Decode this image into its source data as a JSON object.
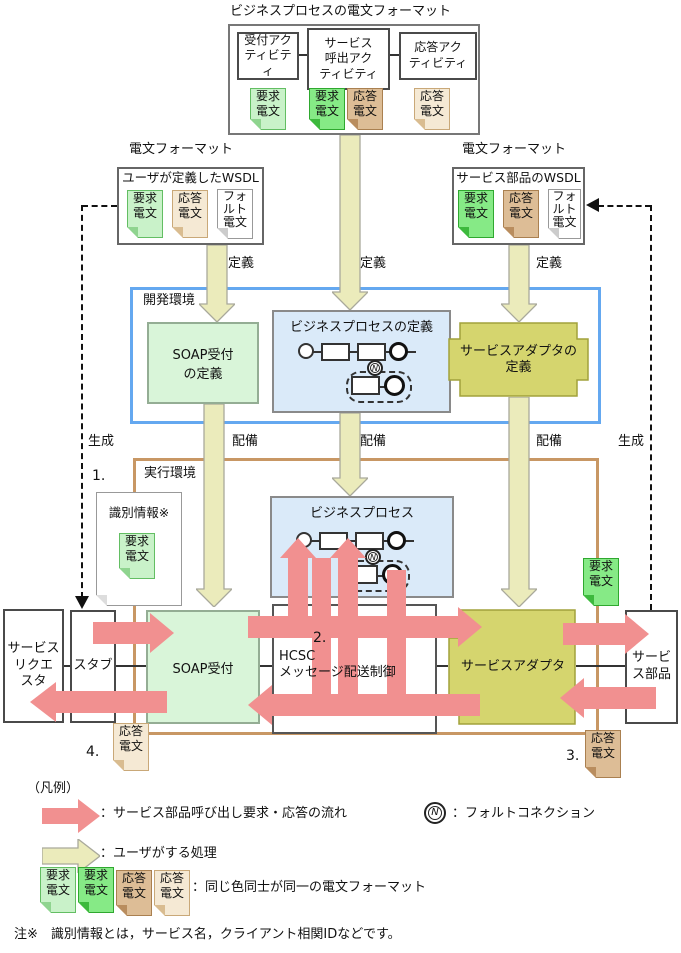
{
  "colors": {
    "pink_arrow": "#F19090",
    "yellow_arrow_fill": "#EBEBBB",
    "yellow_arrow_stroke": "#A9A99B",
    "green_bright": "#86EA86",
    "green_light": "#C9F2C9",
    "tan_dark": "#DDBD96",
    "tan_light": "#F5E9D4",
    "olive": "#D5D56E",
    "dev_border": "#64A8F0",
    "exec_border": "#C89764"
  },
  "top_format": {
    "title": "ビジネスプロセスの電文フォーマット",
    "activities": [
      {
        "label": "受付アク\nティビティ"
      },
      {
        "label": "サービス\n呼出アク\nティビティ"
      },
      {
        "label": "応答アク\nティビティ"
      }
    ]
  },
  "doc_labels": {
    "request": "要求\n電文",
    "response": "応答\n電文",
    "fault": "フォ\nルト\n電文"
  },
  "wsdl_left": {
    "title": "電文フォーマット",
    "label": "ユーザが定義したWSDL"
  },
  "wsdl_right": {
    "title": "電文フォーマット",
    "label": "サービス部品のWSDL"
  },
  "flow_labels": {
    "define": "定義",
    "deploy": "配備",
    "generate": "生成"
  },
  "dev_env": {
    "label": "開発環境",
    "soap_def": "SOAP受付\nの定義",
    "bp_def": "ビジネスプロセスの定義",
    "adapter_def": "サービスアダプタの\n定義"
  },
  "exec_env": {
    "label": "実行環境",
    "step1": "1.",
    "id_info": "識別情報※",
    "bp": "ビジネスプロセス",
    "requester": "サービス\nリクエ\nスタ",
    "stub": "スタブ",
    "soap": "SOAP受付",
    "hcsc_step": "2.",
    "hcsc": "HCSC\nメッセージ配送制御",
    "adapter": "サービスアダプタ",
    "part": "サービ\nス部品",
    "step3": "3.",
    "step4": "4."
  },
  "fault_symbol": "N",
  "legend": {
    "header": "（凡例）",
    "flow": "：サービス部品呼び出し要求・応答の流れ",
    "fault": "：フォルトコネクション",
    "user": "：ユーザがする処理",
    "format": "：同じ色同士が同一の電文フォーマット"
  },
  "note": "注※　識別情報とは，サービス名，クライアント相関IDなどです。"
}
